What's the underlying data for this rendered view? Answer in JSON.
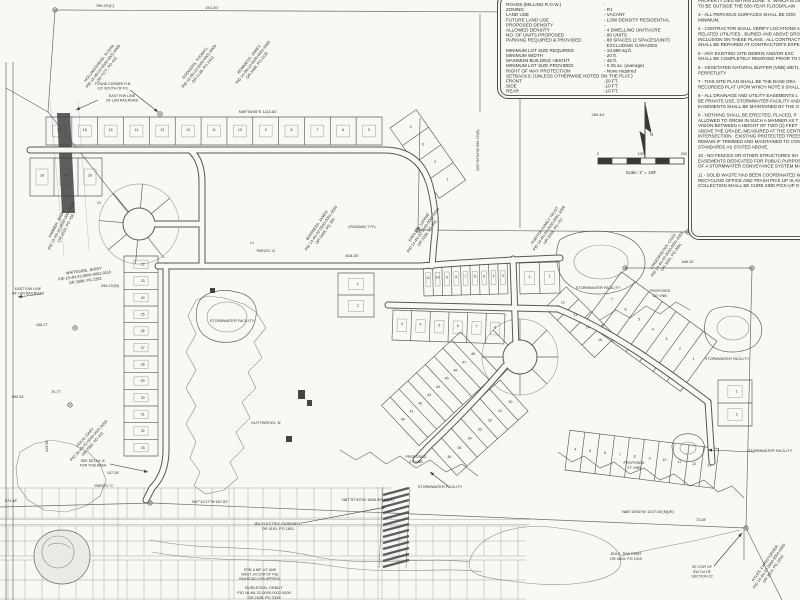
{
  "colors": {
    "paper": "#f9f8f5",
    "ink": "#3d3d3d",
    "dark_band": "#4f4f4f",
    "text": "#333333"
  },
  "north": {
    "label": "N"
  },
  "scale_bar": {
    "ticks": [
      "0",
      "100'",
      "200'"
    ],
    "caption": "Scale: 1\" = 100'"
  },
  "site_table": {
    "rows": [
      {
        "label": "ROADS (MILLING R.O.W.)",
        "value": "-"
      },
      {
        "label": "ZONING",
        "value": "- R1"
      },
      {
        "label": "LAND USE",
        "value": "- VACANT"
      },
      {
        "label": "FUTURE LAND USE",
        "value": "- LOW DENSITY RESIDENTIAL"
      },
      {
        "label": "PROPOSED DENSITY",
        "value": "-"
      },
      {
        "label": "ALLOWED DENSITY",
        "value": "- 4 DWELLING UNIT/ACRE"
      },
      {
        "label": "NO. OF UNITS PROPOSED",
        "value": "- 90 UNITS"
      },
      {
        "label": "PARKING REQUIRED & PROVIDED",
        "value": "- 88 SPACES (2 SPACES/UNIT)\n  EXCLUDING GARAGES"
      },
      {
        "label": "MINIMUM LOT SIZE REQUIRED",
        "value": "- 10,890 sq.ft."
      },
      {
        "label": "MINIMUM WIDTH",
        "value": "- 20 ft."
      },
      {
        "label": "MAXIMUM BUILDING HEIGHT",
        "value": "- 45 ft."
      },
      {
        "label": "MINIMUM LOT SIZE PROVIDED",
        "value": "- 0.25 ac. (average)"
      },
      {
        "label": "RIGHT OF WAY PROTECTION",
        "value": "- None required"
      },
      {
        "label": "SETBACKS: (UNLESS OTHERWISE NOTED ON THE PLAT.)",
        "value": ""
      },
      {
        "label": "FRONT",
        "value": "-20 FT."
      },
      {
        "label": "SIDE",
        "value": "-10 FT."
      },
      {
        "label": "REAR",
        "value": "-10 FT."
      }
    ]
  },
  "notes": [
    "PROPERTY LIES WITHIN ZONE \"X\" WHICH IS DET\nTO BE OUTSIDE THE 500-YEAR FLOODPLAIN",
    "3 - ALL PERVIOUS SURFACES SHALL BE SOD\nMINIMUM.",
    "4 - CONTRACTOR SHALL VERIFY LOCATIONS A\nRELATED UTILITIES , BURIED AND ABOVE GROU\nINCLUSION ON THESE PLANS.  ALL CONTRACT\nSHALL BE REPAIRED AT CONTRACTOR'S EXPEN",
    "5 - ANY EXISTING SITE DEBRIS AND/OR EXC\nSHALL BE COMPLETELY REMOVED PRIOR TO C",
    "6 - VEGETATED NATURAL BUFFER (VNB) WETL\nPERPETUITY",
    "7 - THIS SITE PLAN SHALL BE THE BASE DRA\nRECORDED PLAT UPON WHICH NOTE 6 SHALL",
    "8 - ALL DRAINAGE AND UTILITY EASEMENTS L\nBE PRIVATE USE, STORMWATER FACILITY AND\nEASEMENTS SHALL BE MAINTAINED BY THE O",
    "9 - NOTHING SHALL BE ERECTED, PLACED, P\nALLOWED TO GROW IN SUCH A MANNER AS T\nVISION BETWEEN A HEIGHT OF TWO (2) FEET\nABOVE THE GRADE, MEASURED AT THE CENTE\nINTERSECTION.  EXISTING PROTECTED TREES\nREMAIN IF TRIMMED AND MAINTAINED TO CON\nSTANDARDS AS STATED ABOVE.",
    "10 - NO FENCES OR OTHER STRUCTURES SH\nEASEMENTS DEDICATED FOR PUBLIC PURPOS\nOF A STORMWATER CONVEYANCE SYSTEM MA",
    "11 - SOLID WASTE HAS BEEN COORDINATED W\nRECYCLING OFFICE AND TRASH PICK UP IS AV\nCOLLECTION SHALL BE CURB SIDE PICK-UP O"
  ],
  "lot_groups": [
    {
      "x": 46,
      "y": 145,
      "ang": 0,
      "len": 336,
      "d": 28,
      "n": 13,
      "pad": true,
      "nums": [
        "17",
        "16",
        "15",
        "14",
        "13",
        "12",
        "11",
        "10",
        "9",
        "8",
        "7",
        "6",
        "5"
      ]
    },
    {
      "x": 390,
      "y": 128,
      "ang": 55,
      "len": 86,
      "d": 32,
      "n": 4,
      "pad": false,
      "nums": [
        "4",
        "3",
        "2",
        "1"
      ]
    },
    {
      "x": 30,
      "y": 196,
      "ang": 0,
      "len": 72,
      "d": 38,
      "n": 3,
      "pad": true,
      "nums": [
        "18",
        "19",
        "20"
      ]
    },
    {
      "x": 124,
      "y": 256,
      "ang": 90,
      "len": 200,
      "d": 34,
      "n": 12,
      "pad": true,
      "nums": [
        "22",
        "23",
        "24",
        "25",
        "26",
        "27",
        "28",
        "29",
        "30",
        "31",
        "32",
        "33"
      ]
    },
    {
      "x": 338,
      "y": 273,
      "ang": 90,
      "len": 44,
      "d": 36,
      "n": 2,
      "pad": true,
      "nums": [
        "1",
        "2"
      ]
    },
    {
      "x": 424,
      "y": 296,
      "ang": -1.5,
      "len": 84,
      "d": 33,
      "n": 9,
      "pad": true,
      "nums": [
        "11",
        "10",
        "9",
        "8",
        "7",
        "6",
        "5",
        "4",
        "3"
      ]
    },
    {
      "x": 520,
      "y": 294,
      "ang": -1.5,
      "len": 40,
      "d": 31,
      "n": 2,
      "pad": true,
      "nums": [
        "2",
        "1"
      ]
    },
    {
      "x": 392,
      "y": 340,
      "ang": 2,
      "len": 112,
      "d": 30,
      "n": 6,
      "pad": true,
      "nums": [
        "3",
        "4",
        "5",
        "6",
        "7",
        "8"
      ]
    },
    {
      "x": 545,
      "y": 308,
      "ang": 45,
      "len": 70,
      "d": 30,
      "n": 4,
      "pad": false,
      "nums": [
        "12",
        "13",
        "14",
        "15"
      ]
    },
    {
      "x": 585,
      "y": 322,
      "ang": 36,
      "len": 118,
      "d": 62,
      "n": 7,
      "pad": false,
      "nums": [
        "7",
        "6",
        "5",
        "4",
        "3",
        "2",
        "1"
      ]
    },
    {
      "x": 565,
      "y": 470,
      "ang": 7,
      "len": 150,
      "d": 40,
      "n": 10,
      "pad": false,
      "nums": [
        "4",
        "5",
        "6",
        "7",
        "8",
        "9",
        "10",
        "11",
        "12",
        "13"
      ]
    },
    {
      "x": 498,
      "y": 372,
      "ang": 137,
      "len": 108,
      "d": -55,
      "n": 9,
      "pad": false,
      "nums": [
        "48",
        "47",
        "46",
        "45",
        "44",
        "43",
        "42",
        "41",
        "40"
      ]
    },
    {
      "x": 500,
      "y": 380,
      "ang": 138,
      "len": 96,
      "d": 42,
      "n": 7,
      "pad": false,
      "nums": [
        "30",
        "31",
        "32",
        "33",
        "34",
        "35",
        "36"
      ]
    },
    {
      "x": 718,
      "y": 380,
      "ang": 90,
      "len": 46,
      "d": 34,
      "n": 2,
      "pad": true,
      "nums": [
        "1",
        "2"
      ]
    }
  ],
  "labels": [
    {
      "t": "769.20'(C)",
      "x": 105,
      "y": 7,
      "s": 4
    },
    {
      "t": "201.40'",
      "x": 212,
      "y": 9,
      "s": 4
    },
    {
      "t": "N89°06'06\"E  1115.82'",
      "x": 258,
      "y": 113,
      "s": 4
    },
    {
      "t": "280.44'",
      "x": 598,
      "y": 116,
      "s": 4
    },
    {
      "t": "N00°04'54\"W  596.19'(R)",
      "x": 479,
      "y": 150,
      "r": -90,
      "s": 3.8
    },
    {
      "t": "N01°36'36\"E  374.53'",
      "x": 700,
      "y": 70,
      "r": -90,
      "s": 3.8
    },
    {
      "t": "HOLLINGSHEAD, SUSAN\nPID 15-4N-22-0500-0001-0008\nOR 7377, PG 432",
      "x": 100,
      "y": 64,
      "r": -52,
      "s": 3.9
    },
    {
      "t": "RODGERS, THOMAS\nPID 15-4N-22-0500-0001-0009\nOR 2138, PG 2421",
      "x": 196,
      "y": 64,
      "r": -52,
      "s": 3.9
    },
    {
      "t": "BONNIESS, JAMES\nPID 14-4N-22-0500-0001-0000\nOR 3498, PG 3135",
      "x": 250,
      "y": 60,
      "r": -52,
      "s": 3.9
    },
    {
      "t": "FOUND CORNER R.B.\n0.6' SOUTH OF P/L",
      "x": 113,
      "y": 85,
      "s": 3.5
    },
    {
      "t": "EAST R/W LINE\nOF L&N RAILROAD",
      "x": 122,
      "y": 97,
      "s": 3.6
    },
    {
      "t": "EAST R/W LINE\nOF L&N RAILROAD",
      "x": 28,
      "y": 290,
      "s": 3.6
    },
    {
      "t": "WHITESIDE, JERRY\nPID 15-4N-23-0000-0001-0110\nOR 3308, PG 2282",
      "x": 84,
      "y": 272,
      "r": -8,
      "s": 3.9
    },
    {
      "t": "FARMER, JERRY\nPID 15-4N-22-0500-0001-0100\nOR 2222, PG 708",
      "x": 58,
      "y": 224,
      "r": -62,
      "s": 3.9
    },
    {
      "t": "BONNIESS, JAMES\nPID 14-4N-22-0500-0001-0030\nOR 3498, PG 305",
      "x": 318,
      "y": 226,
      "r": -55,
      "s": 3.9
    },
    {
      "t": "ENGLISH, LONNIE\nPID 14-4N-22-0500-0001-0040\nOR 3396, PG 342",
      "x": 420,
      "y": 228,
      "r": -55,
      "s": 3.9
    },
    {
      "t": "PORTER FAMILY TRUST\nPID 14-4N-22-0500-0001-2000\nOR 2098, PG 757",
      "x": 546,
      "y": 226,
      "r": -55,
      "s": 3.9
    },
    {
      "t": "LINGENFELTER, CHAD\nPID 14-4N-22-0500-0001-0050\nOR 3495, PG 2081",
      "x": 664,
      "y": 252,
      "r": -55,
      "s": 3.9
    },
    {
      "t": "RYLES, CHRISTOPHER\nPID 14-4N-22-0000-0004-0000\nOR 3614, PG 2250",
      "x": 766,
      "y": 564,
      "r": -55,
      "s": 3.9
    },
    {
      "t": "HOLM, GARY\nPID 16-4N-22-0000-0001-0005\nOR 2382, PG 431",
      "x": 86,
      "y": 438,
      "r": -48,
      "s": 3.9
    },
    {
      "t": "818.35'",
      "x": 352,
      "y": 257,
      "s": 4
    },
    {
      "t": "296.23'(M)",
      "x": 110,
      "y": 287,
      "s": 3.8
    },
    {
      "t": "436.27'",
      "x": 42,
      "y": 326,
      "s": 3.8
    },
    {
      "t": "76.77'",
      "x": 56,
      "y": 393,
      "s": 3.8
    },
    {
      "t": "593.52'",
      "x": 18,
      "y": 398,
      "s": 3.8
    },
    {
      "t": "443.56'",
      "x": 48,
      "y": 446,
      "r": -90,
      "s": 3.8
    },
    {
      "t": "147.26'",
      "x": 113,
      "y": 474,
      "s": 3.8
    },
    {
      "t": "574.48'",
      "x": 11,
      "y": 502,
      "s": 3.8
    },
    {
      "t": "N87°42'17\"W  657.81'",
      "x": 210,
      "y": 503,
      "s": 3.8
    },
    {
      "t": "N87°57'49\"W  1565.39'(M)(R)",
      "x": 368,
      "y": 501,
      "s": 4
    },
    {
      "t": "N88°18'36\"W  1027.04'(M)(R)",
      "x": 648,
      "y": 513,
      "s": 4
    },
    {
      "t": "73.38'",
      "x": 701,
      "y": 521,
      "s": 3.8
    },
    {
      "t": "646.32'",
      "x": 688,
      "y": 263,
      "s": 3.8
    },
    {
      "t": "SEE DETAIL 'A'\nFOR THIS AREA",
      "x": 93,
      "y": 462,
      "s": 3.5
    },
    {
      "t": "PARCEL 'C'",
      "x": 104,
      "y": 487,
      "s": 3.6
    },
    {
      "t": "PARCEL 'A'",
      "x": 266,
      "y": 252,
      "s": 3.6
    },
    {
      "t": "L2",
      "x": 252,
      "y": 244,
      "s": 3.6
    },
    {
      "t": "(ROADWAY TYP.)",
      "x": 362,
      "y": 228,
      "s": 3.4
    },
    {
      "t": "JEA ELECTRIC EASEMENT\nOR 4191, PG 1601",
      "x": 278,
      "y": 525,
      "s": 3.8
    },
    {
      "t": "JEA E. R/W ESMT\nOR 3615, PG 1910",
      "x": 626,
      "y": 555,
      "s": 3.8
    },
    {
      "t": "STORMWATER FACILITY",
      "x": 232,
      "y": 322,
      "s": 3.8
    },
    {
      "t": "STORMWATER FACILITY",
      "x": 598,
      "y": 289,
      "s": 3.8
    },
    {
      "t": "STORMWATER FACILITY",
      "x": 727,
      "y": 360,
      "s": 3.8
    },
    {
      "t": "STORMWATER FACILITY",
      "x": 770,
      "y": 452,
      "s": 3.8
    },
    {
      "t": "STORMWATER FACILITY",
      "x": 440,
      "y": 488,
      "s": 3.8
    },
    {
      "t": "PROPOSED\n27' VNB",
      "x": 416,
      "y": 458,
      "s": 3.7
    },
    {
      "t": "PROPOSED\n27' VNB",
      "x": 634,
      "y": 464,
      "s": 3.7
    },
    {
      "t": "PROPOSED\n20' VNB",
      "x": 660,
      "y": 292,
      "s": 3.7
    },
    {
      "t": "OUT PARCEL 'A'",
      "x": 266,
      "y": 424,
      "s": 4
    },
    {
      "t": "SE COR OF\nSW 1/4 OF\nSECTION 22",
      "x": 702,
      "y": 568,
      "s": 3.7
    },
    {
      "t": "POB: A NIP 1/2\" AND\nWEST 1/4 COR OF THE\nRAILROAD COR APPROX.",
      "x": 260,
      "y": 571,
      "s": 3.4
    },
    {
      "t": "BURLESON, GRADY\nPID 16-4N-22-0000-0002-0000\nOR 2326, PG 2326",
      "x": 264,
      "y": 589,
      "s": 3.9
    },
    {
      "t": "21",
      "x": 99,
      "y": 204,
      "s": 3.6
    }
  ]
}
